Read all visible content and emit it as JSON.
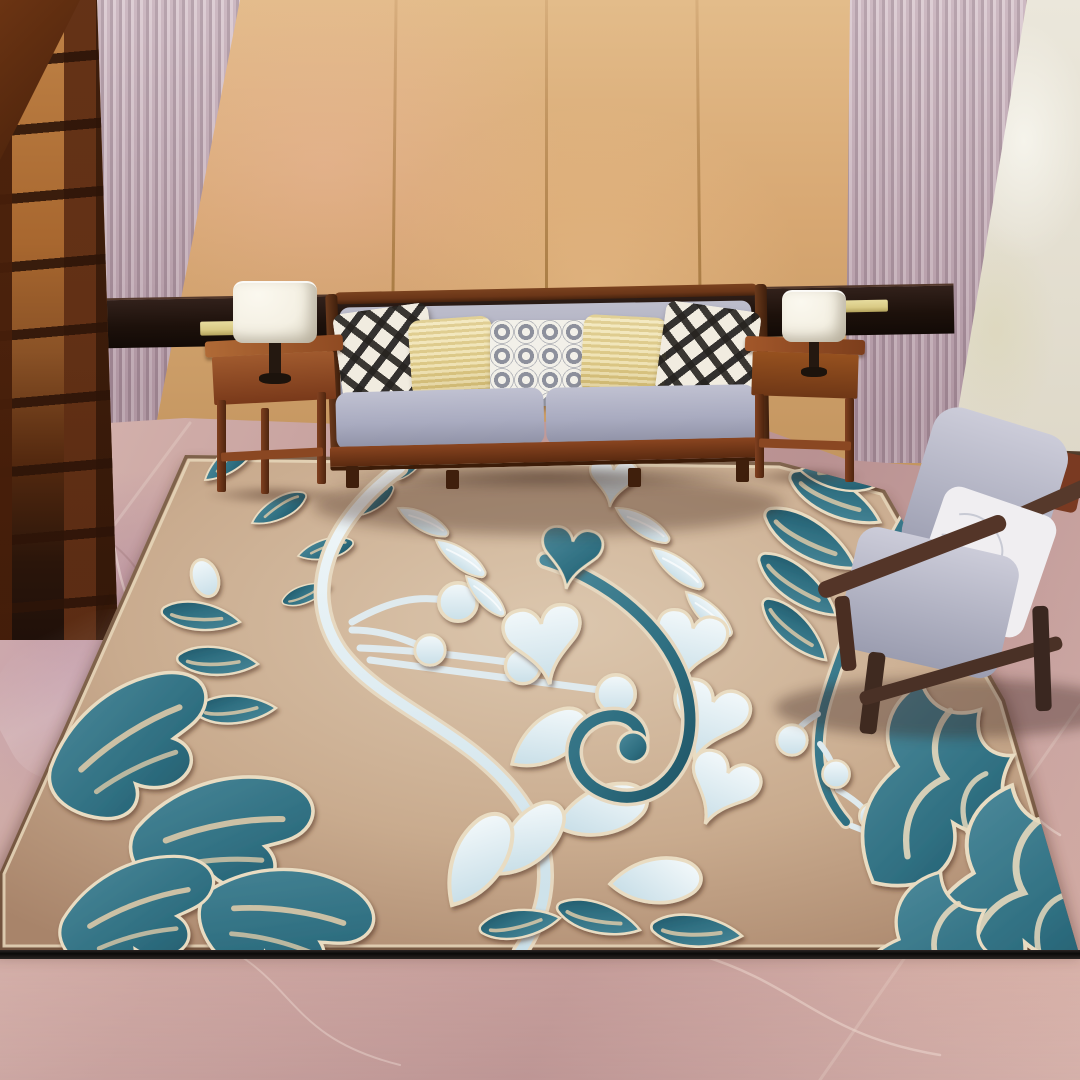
{
  "scene": {
    "setting": "interior product photograph of an area rug staged in a living room",
    "elements": [
      {
        "name": "glass-door-left",
        "desc": "dark wood French door with amber glass panes, far left"
      },
      {
        "name": "pleated-panel-left",
        "desc": "pink-grey vertically pleated curtain panel"
      },
      {
        "name": "wood-paneled-wall",
        "desc": "tan vertical wood panel wall with seams"
      },
      {
        "name": "pleated-panel-right",
        "desc": "pink-grey vertically pleated curtain panel"
      },
      {
        "name": "textured-wall-right",
        "desc": "cream textured accent wall with dark baseboard"
      },
      {
        "name": "picture-rail",
        "desc": "dark wood horizontal rail with two brass plaques"
      },
      {
        "name": "sofa",
        "desc": "wood-frame sofa with grey-violet cushions and five throw pillows: black/white ikat, yellow knit, white ring-print, yellow knit, black/white ikat"
      },
      {
        "name": "side-table-left",
        "desc": "wooden side table with white drum-shade lamp"
      },
      {
        "name": "side-table-right",
        "desc": "wooden side table with white drum-shade lamp"
      },
      {
        "name": "armchair",
        "desc": "dark wood-frame armchair with grey cushions and a white floral pillow, lower right"
      },
      {
        "name": "marble-floor",
        "desc": "rose-pink veined marble tile floor"
      },
      {
        "name": "area-rug",
        "desc": "beige high-pile rug with embossed damask pattern: teal leaves, teal swirl, feather fronds, powder-blue hearts, petals, teardrops and berry stems outlined in cream"
      },
      {
        "name": "bottom-divider",
        "desc": "thin black horizontal line near the bottom edge, marble continues below"
      }
    ]
  },
  "palette": {
    "wall-tan": "#d8a873",
    "wall-tan-light": "#e3bc8a",
    "wall-seam": "#a97c44",
    "pleat-light": "#d6c3cb",
    "pleat-mid": "#c2aab5",
    "pleat-dark": "#a78f9b",
    "cream-wall": "#ebe7db",
    "rail-wood": "#2a1a10",
    "plaque-gold": "#d9ca85",
    "door-wood": "#7c3e1d",
    "door-glass": "#b4763a",
    "marble-base": "#c49e9c",
    "marble-light": "#ddc0ba",
    "marble-dark": "#a97f83",
    "marble-vein": "#f1e3dd",
    "rug-bg-light": "#dcc7ae",
    "rug-bg-mid": "#c9ab8e",
    "rug-bg-dark": "#a8846a",
    "rug-teal": "#2f6f81",
    "rug-teal-dark": "#1f5566",
    "rug-teal-light": "#4e8b9c",
    "rug-pale": "#dcebf0",
    "rug-pale-bright": "#f2f8fa",
    "rug-outline": "#e9dcc2",
    "sofa-wood": "#6b3618",
    "sofa-cushion": "#a6a8bd",
    "pillow-ikat-dark": "#26231f",
    "pillow-ikat-light": "#f1ece0",
    "pillow-yellow": "#e9d797",
    "pillow-ring-gray": "#8d909c",
    "table-wood": "#a05a2e",
    "lamp-shade": "#f4f0e3",
    "chair-wood": "#513629",
    "chair-cushion": "#b7b9c9",
    "chair-pillow": "#efedf0",
    "divider-black": "#0b0a09"
  }
}
